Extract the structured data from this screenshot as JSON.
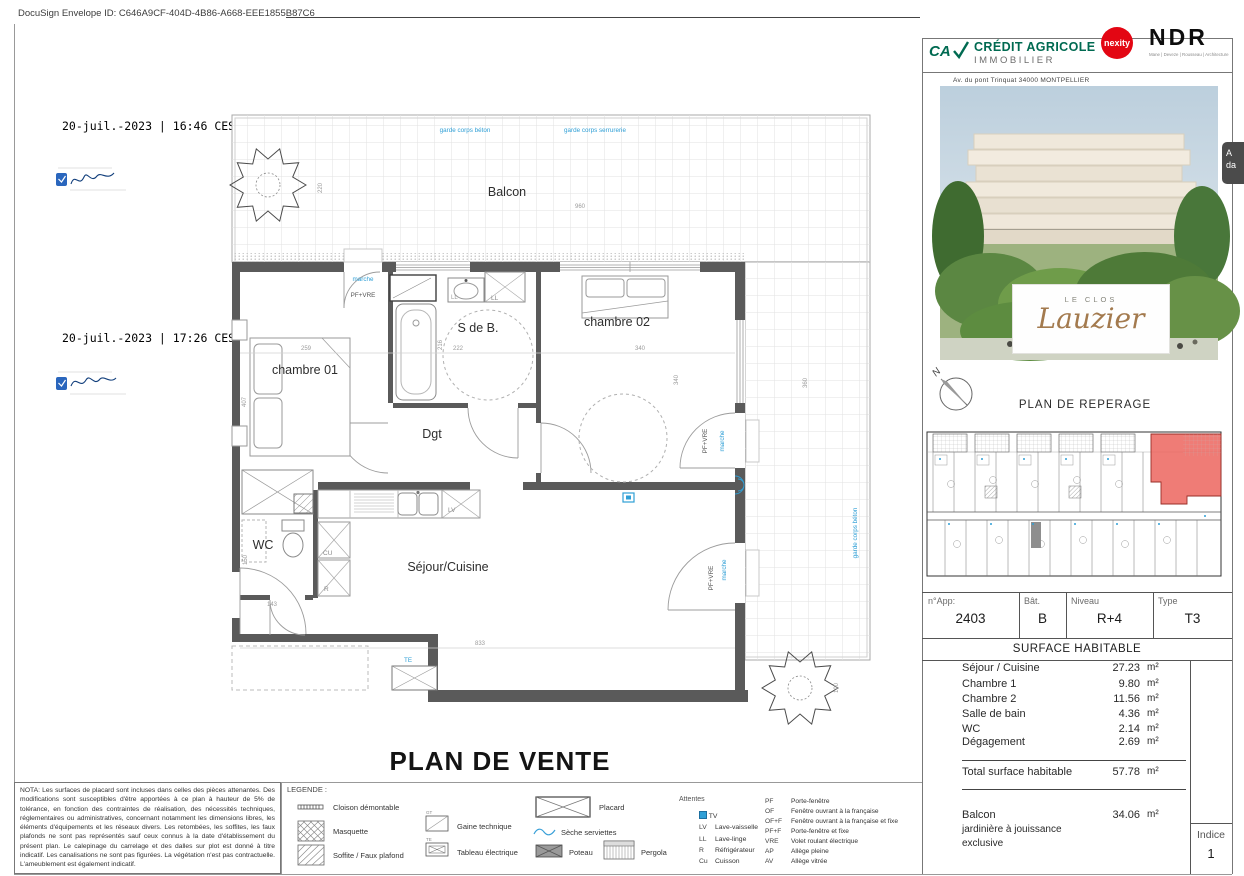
{
  "docusign": {
    "envelope_line": "DocuSign Envelope ID: C646A9CF-404D-4B86-A668-EEE1855B87C6",
    "timestamps": [
      "20-juil.-2023 | 16:46 CEST",
      "20-juil.-2023 | 17:26 CEST"
    ],
    "side_tab_line1": "A",
    "side_tab_line2": "da"
  },
  "plan": {
    "title": "PLAN DE VENTE",
    "balcon": "Balcon",
    "chambre01": "chambre 01",
    "chambre02": "chambre 02",
    "sdb": "S de B.",
    "dgt": "Dgt",
    "wc": "WC",
    "sejour": "Séjour/Cuisine",
    "garde_beton": "garde corps béton",
    "garde_serrurerie": "garde corps serrurerie",
    "marche": "marche",
    "pfvre": "PF+VRE",
    "ll": "LL",
    "lv": "LV",
    "cu": "CU",
    "r": "R",
    "te": "TE",
    "d220": "220",
    "d960": "960",
    "d360": "360",
    "d259": "259",
    "d407": "407",
    "d216": "216",
    "d222": "222",
    "d340a": "340",
    "d340b": "340",
    "d150": "150",
    "d143": "143",
    "d833": "833",
    "d100": "100"
  },
  "logos": {
    "ca_monogram": "CA",
    "ca_name": "CRÉDIT AGRICOLE",
    "ca_sub": "IMMOBILIER",
    "nexity": "nexity",
    "ndr": "NDR",
    "ndr_sub": "Mane | Deveze | Rousseau | Architecture"
  },
  "panel": {
    "address": "Av. du pont Trinquat 34000  MONTPELLIER",
    "brand_top": "LE CLOS",
    "brand_script": "Lauzier",
    "north": "N",
    "reperage_title": "PLAN DE REPERAGE",
    "info": {
      "app_label": "n°App:",
      "app": "2403",
      "bat_label": "Bât.",
      "bat": "B",
      "niveau_label": "Niveau",
      "niveau": "R+4",
      "type_label": "Type",
      "type": "T3"
    },
    "surface_title": "SURFACE HABITABLE",
    "surfaces": [
      {
        "name": "Séjour / Cuisine",
        "value": "27.23",
        "unit": "m²"
      },
      {
        "name": "Chambre 1",
        "value": "9.80",
        "unit": "m²"
      },
      {
        "name": "Chambre 2",
        "value": "11.56",
        "unit": "m²"
      },
      {
        "name": "Salle de bain",
        "value": "4.36",
        "unit": "m²"
      },
      {
        "name": "WC",
        "value": "2.14",
        "unit": "m²"
      },
      {
        "name": "Dégagement",
        "value": "2.69",
        "unit": "m²"
      }
    ],
    "total": {
      "name": "Total surface habitable",
      "value": "57.78",
      "unit": "m²"
    },
    "balcon_row": {
      "name": "Balcon",
      "value": "34.06",
      "unit": "m²",
      "note1": "jardinière à jouissance",
      "note2": "exclusive"
    },
    "indice": {
      "label": "Indice",
      "value": "1"
    }
  },
  "nota": "NOTA: Les surfaces de placard sont incluses dans celles des pièces attenantes. Des modifications sont susceptibles d'être apportées à ce plan à hauteur de 5% de tolérance, en fonction des contraintes de réalisation, des nécessités techniques, réglementaires ou administratives, concernant notamment les dimensions libres, les éléments d'équipements et les réseaux divers. Les retombées, les soffites, les faux plafonds ne sont pas représentés sauf ceux connus à la date d'établissement du présent plan. Le calepinage du carrelage et des dalles sur plot est donné à titre indicatif. Les canalisations ne sont pas figurées. La végétation n'est pas contractuelle. L'ameublement est également indicatif.",
  "legend": {
    "title": "LEGENDE :",
    "col1": [
      {
        "label": "Cloison démontable"
      },
      {
        "label": "Masquette"
      },
      {
        "label": "Soffite / Faux plafond"
      }
    ],
    "col2": [
      {
        "abbr": "GT",
        "label": "Gaine technique"
      },
      {
        "abbr": "TE",
        "label": "Tableau électrique"
      }
    ],
    "col3": [
      {
        "label": "Placard"
      },
      {
        "label": "Sèche serviettes"
      },
      {
        "label": "Poteau"
      }
    ],
    "col4": [
      {
        "label": "Pergola"
      }
    ],
    "attentes": {
      "title": "Attentes",
      "items": [
        {
          "abbr": "",
          "label": "TV"
        },
        {
          "abbr": "LV",
          "label": "Lave-vaisselle"
        },
        {
          "abbr": "LL",
          "label": "Lave-linge"
        },
        {
          "abbr": "R",
          "label": "Réfrigérateur"
        },
        {
          "abbr": "Cu",
          "label": "Cuisson"
        }
      ]
    },
    "abbrevs": [
      {
        "abbr": "PF",
        "label": "Porte-fenêtre"
      },
      {
        "abbr": "OF",
        "label": "Fenêtre ouvrant à la française"
      },
      {
        "abbr": "OF+F",
        "label": "Fenêtre ouvrant à la française et fixe"
      },
      {
        "abbr": "PF+F",
        "label": "Porte-fenêtre et fixe"
      },
      {
        "abbr": "VRE",
        "label": "Volet roulant électrique"
      },
      {
        "abbr": "AP",
        "label": "Allège pleine"
      },
      {
        "abbr": "AV",
        "label": "Allège vitrée"
      }
    ]
  }
}
